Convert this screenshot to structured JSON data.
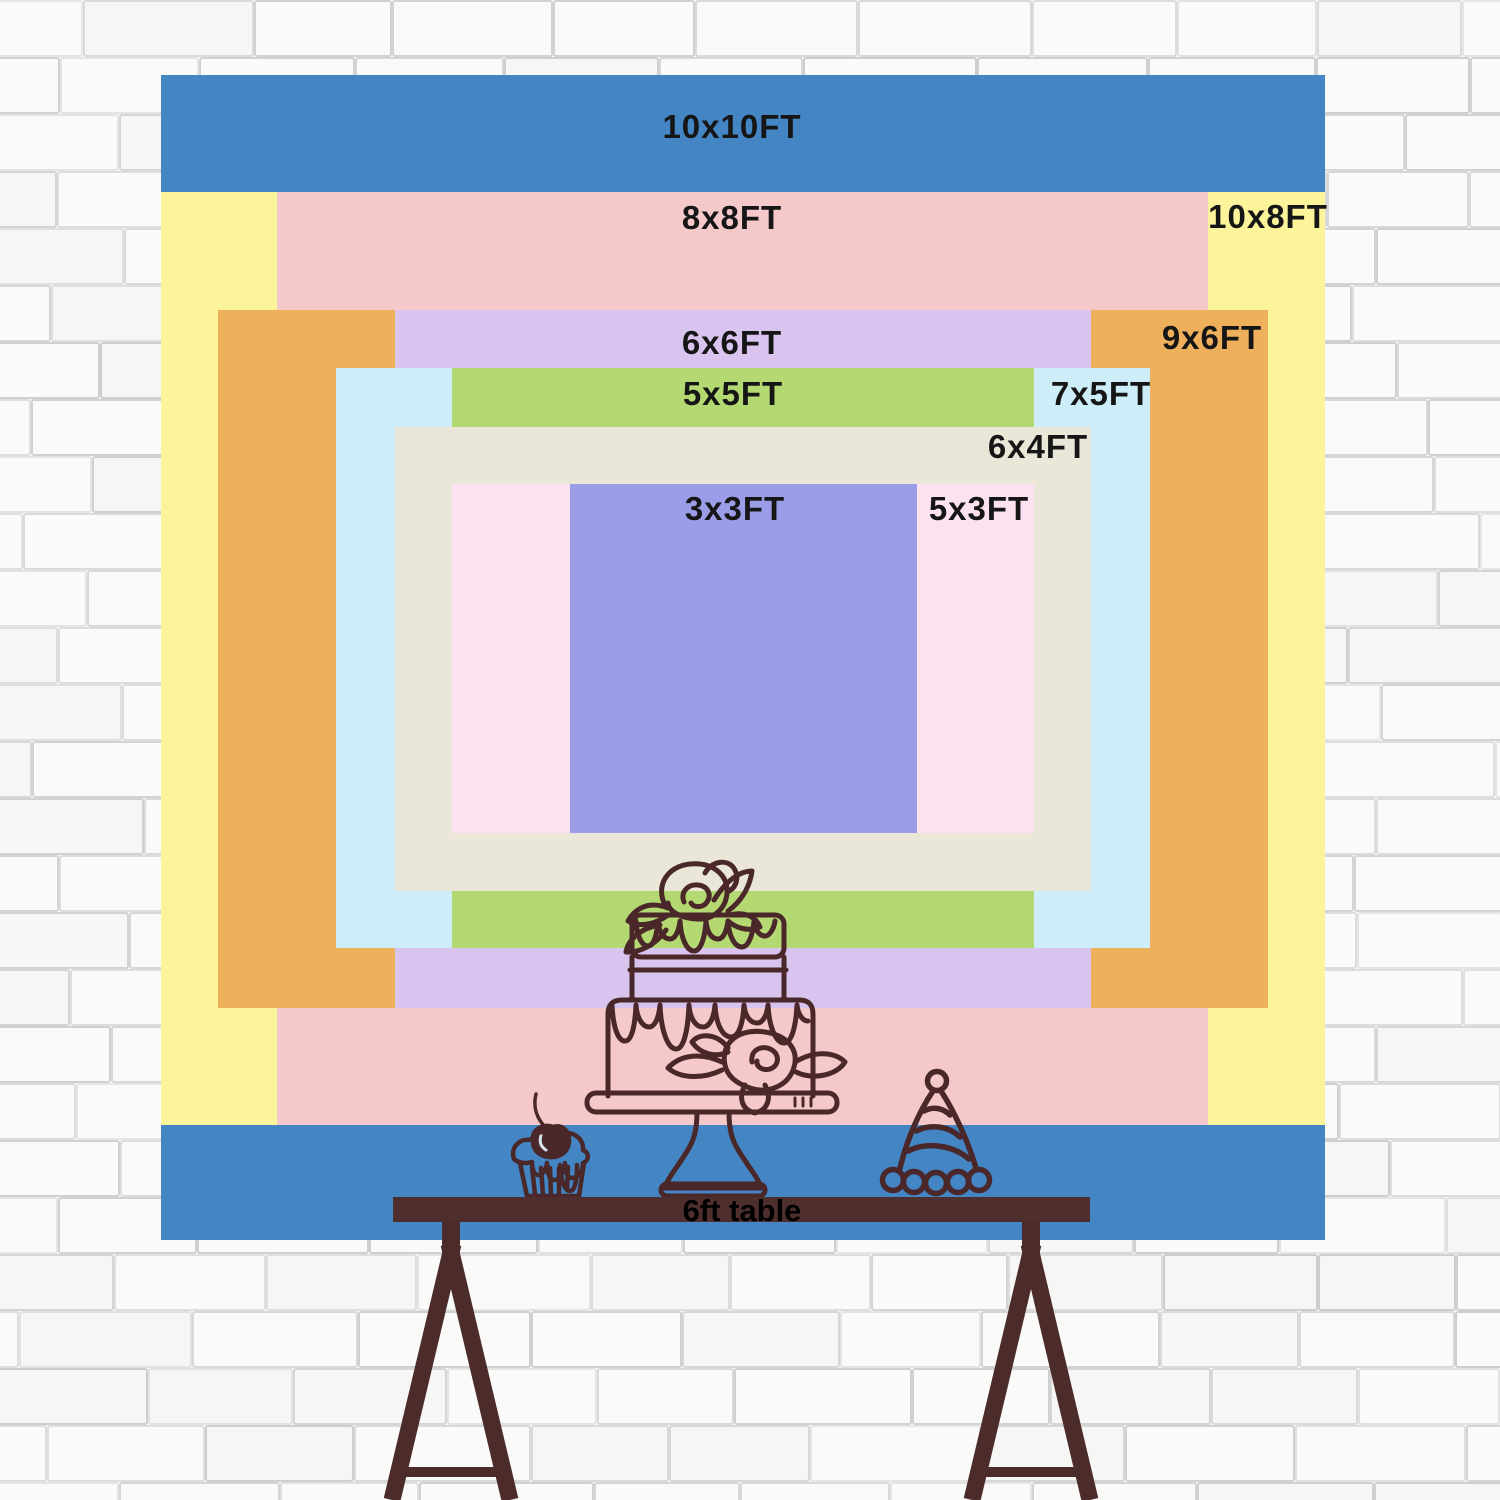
{
  "wall": {
    "background": "#fafaf8",
    "brick_line_color": "rgba(125,125,132,0.30)"
  },
  "backdrop": {
    "label_color": "#161616",
    "sizes": [
      {
        "id": "10x10",
        "label": "10x10FT",
        "color": "#4485c4"
      },
      {
        "id": "10x8",
        "label": "10x8FT",
        "color": "#fbf49a"
      },
      {
        "id": "8x8",
        "label": "8x8FT",
        "color": "#f5c9ca"
      },
      {
        "id": "9x6",
        "label": "9x6FT",
        "color": "#efb05c"
      },
      {
        "id": "6x6",
        "label": "6x6FT",
        "color": "#d9c4ef"
      },
      {
        "id": "7x5",
        "label": "7x5FT",
        "color": "#cdeef8"
      },
      {
        "id": "5x5",
        "label": "5x5FT",
        "color": "#b4d973"
      },
      {
        "id": "6x4",
        "label": "6x4FT",
        "color": "#ebe7d8"
      },
      {
        "id": "5x3",
        "label": "5x3FT",
        "color": "#fce2f1"
      },
      {
        "id": "3x3",
        "label": "3x3FT",
        "color": "#9b9de8"
      }
    ]
  },
  "table": {
    "label": "6ft table",
    "top_color": "#4e2f2e",
    "leg_color": "#4c2c2b",
    "label_color": "#000000"
  },
  "decorations": {
    "line_color": "#4a2728",
    "items": [
      "birthday-cake-icon",
      "cupcake-icon",
      "party-hat-icon"
    ]
  }
}
